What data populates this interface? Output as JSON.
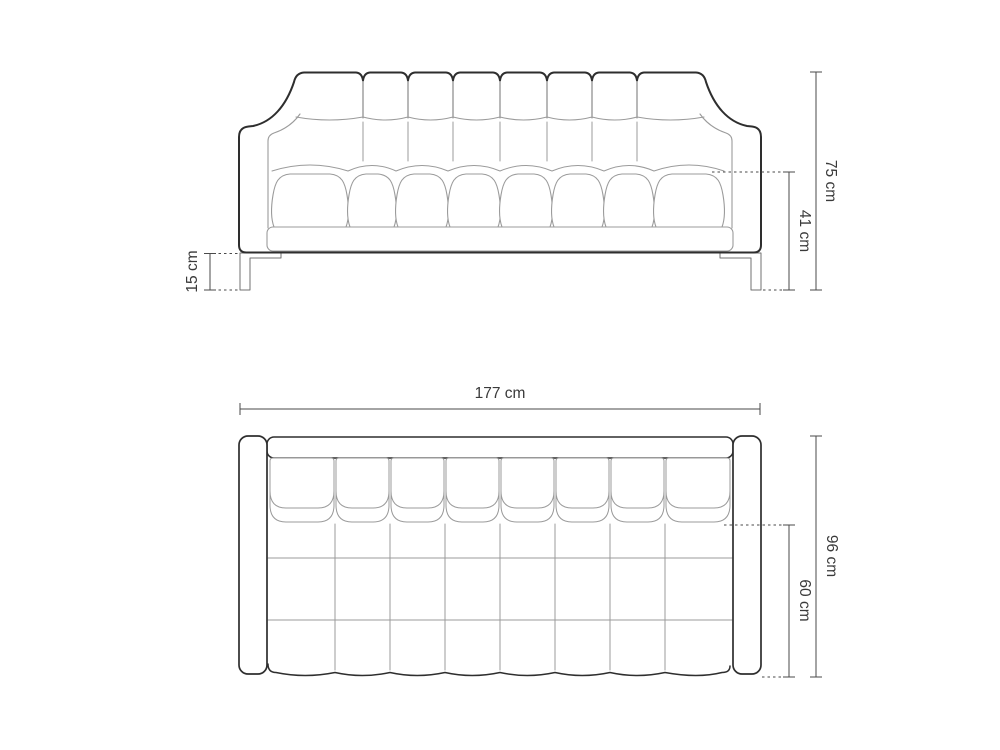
{
  "colors": {
    "outline": "#2e2e2e",
    "detail": "#9b9b9b",
    "detail_dark": "#707070",
    "dim": "#4a4a4a",
    "text": "#3a3a3a",
    "background": "#ffffff"
  },
  "front_view": {
    "overall_height": "75 cm",
    "seat_height": "41 cm",
    "leg_height": "15 cm"
  },
  "top_view": {
    "overall_width": "177 cm",
    "overall_depth": "96 cm",
    "seat_depth": "60 cm"
  }
}
